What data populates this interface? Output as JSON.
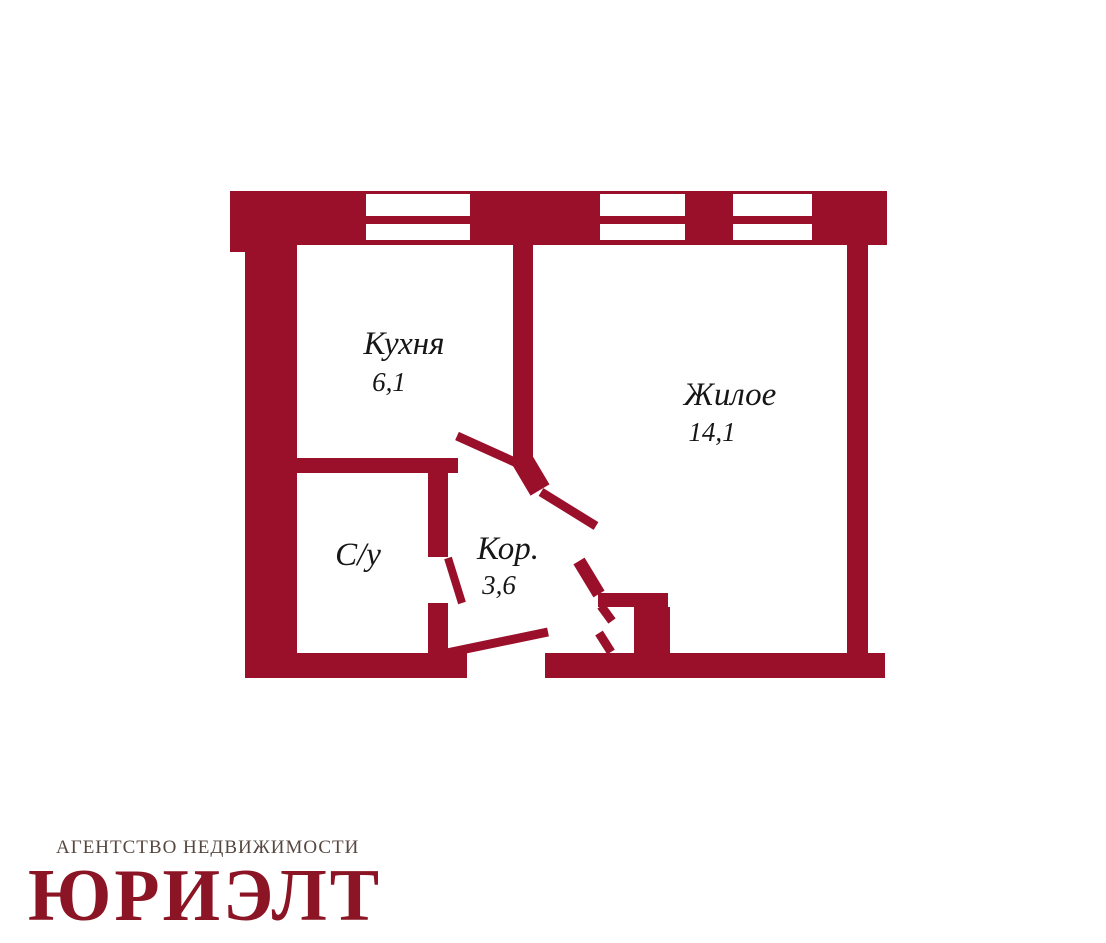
{
  "colors": {
    "background": "#ffffff",
    "wall": "#9a102b",
    "label": "#161616",
    "logo_red": "#8c1525",
    "subtitle_gray": "#564740"
  },
  "plan": {
    "rooms": {
      "kitchen": {
        "label": "Кухня",
        "area": "6,1"
      },
      "living": {
        "label": "Жилое",
        "area": "14,1"
      },
      "bathroom": {
        "label": "С/у"
      },
      "corridor": {
        "label": "Кор.",
        "area": "3,6"
      }
    }
  },
  "branding": {
    "agency_line": "АГЕНТСТВО НЕДВИЖИМОСТИ",
    "agency_name": "ЮРИЭЛТ"
  }
}
